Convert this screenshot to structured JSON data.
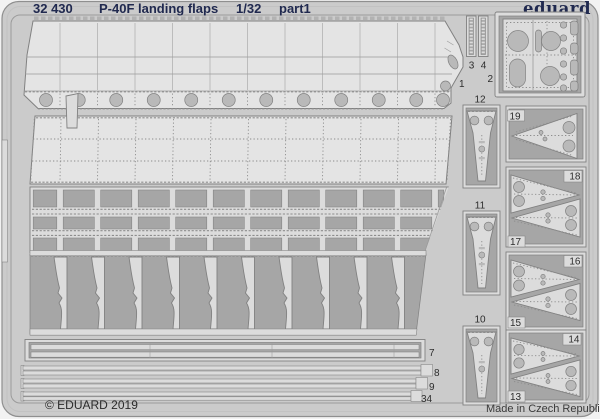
{
  "header": {
    "catalog": "32 430",
    "title": "P-40F landing flaps",
    "scale": "1/32",
    "part": "part1",
    "brand": "eduard"
  },
  "footer": {
    "copyright": "© EDUARD 2019",
    "made_in": "Made in Czech Republic"
  },
  "part_labels": {
    "p1": "1",
    "p2": "2",
    "p3": "3",
    "p4": "4",
    "p7": "7",
    "p8": "8",
    "p9": "9",
    "p10": "10",
    "p11": "11",
    "p12": "12",
    "p13": "13",
    "p14": "14",
    "p15": "15",
    "p16": "16",
    "p17": "17",
    "p18": "18",
    "p19": "19",
    "p34": "34"
  },
  "colors": {
    "page": "#f2f2f2",
    "sheet": "#cbcbcb",
    "part": "#dcdcdc",
    "part2": "#e4e4e4",
    "void": "#a6a6a6",
    "hole": "#b9b9b9",
    "line": "#818181",
    "line2": "#9b9b9b",
    "dots": "#8d8d8d",
    "serr": "#b2b2b2",
    "navy": "#20294f",
    "label": "#2d2d2d",
    "footer_text": "#2b2b2b"
  }
}
